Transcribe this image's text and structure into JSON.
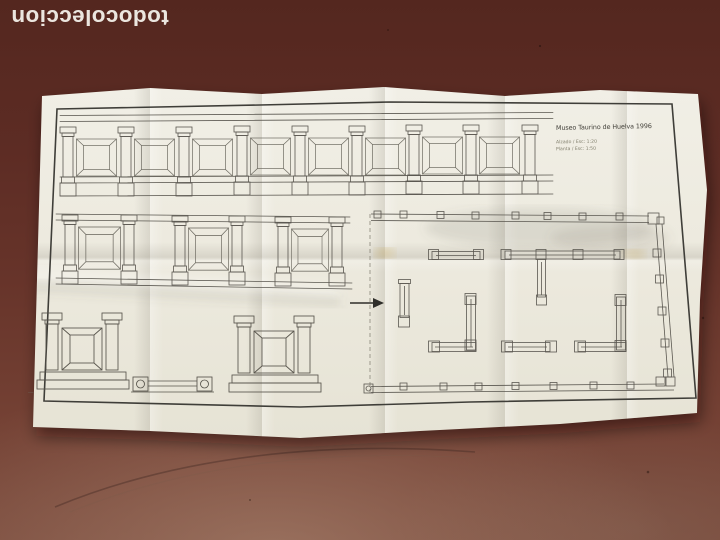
{
  "watermark": {
    "text": "todocoleccion",
    "color": "#f4f1ea"
  },
  "floor": {
    "color": "#5e2d25"
  },
  "sheet": {
    "paper_color": "#eeebe0",
    "ink_color": "#55524a",
    "titleblock": {
      "title": "Museo Taurino de Huelva 1996",
      "scale_line_1": "Alzado / Esc: 1:20",
      "scale_line_2": "Planta / Esc: 1:50"
    },
    "corner_mark": "—·",
    "drawings": {
      "top_elevation": {
        "pilasters": 9,
        "panels": 8
      },
      "middle_elevation": {
        "pilasters": 6,
        "panels": 3
      },
      "detail_units": 2,
      "arrow_direction": "right"
    }
  }
}
